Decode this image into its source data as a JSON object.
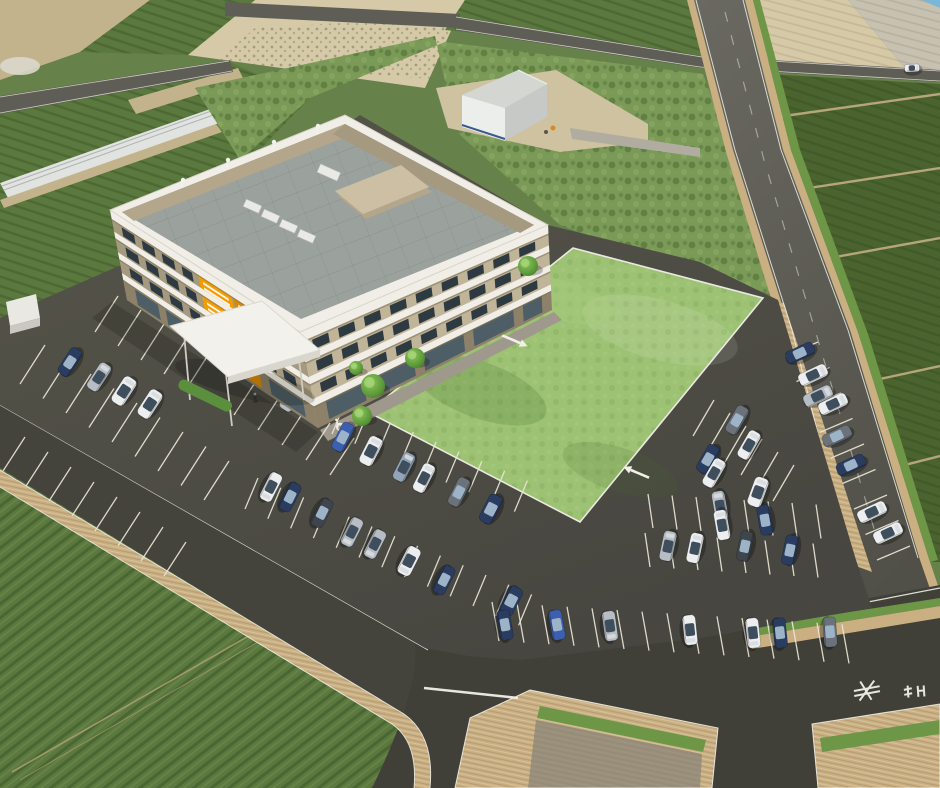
{
  "meta": {
    "title": "aerial-3d-architectural-rendering",
    "width": 940,
    "height": 788,
    "description": "Bird's-eye 3D rendering of a 4-story beige office/hospital building with rooftop equipment, entrance canopy, large lawn, full parking lot with cars, surrounded by farmland and roads"
  },
  "palette": {
    "asphalt": "#4e4d45",
    "asphaltLight": "#5a5950",
    "road": "#5f5e56",
    "roadDark": "#44433c",
    "roadBottom": "#403f38",
    "line": "#f0efe8",
    "stall": "#e9e6d6",
    "lawn": "#9dc273",
    "lawnLight": "#b3d38a",
    "lawnDark": "#83a95a",
    "fieldGreen": "#66824a",
    "fieldGreenRow": "#5b783e",
    "fieldGreenDark": "#4a632f",
    "fieldBush": "#7b9a58",
    "fieldTan": "#d6c9a8",
    "fieldTanDark": "#c3b38c",
    "gravel": "#c6c1b1",
    "dirt": "#cfc2a0",
    "sidewalk": "#c9af81",
    "grassStrip": "#6d9747",
    "curbWall": "#9aa28c",
    "bandWhite": "#f0eee6",
    "trim": "#7d7258",
    "wallSW": "#a59a7f",
    "wallSE": "#c0b499",
    "wallGround": "#8d8269",
    "win": "#2e3a42",
    "glass": "#4e5e66",
    "orange": "#f39c00",
    "orangeDark": "#d98a00",
    "roofGray": "#9ba19c",
    "roofTan": "#b4a68b",
    "roofTanTop": "#cdbfa3",
    "canopy": "#f2f1ec",
    "canopyEdge": "#d9d6cd",
    "pave": "#9e998c",
    "tree1": "#7fbb52",
    "tree2": "#4e8a30",
    "shed": "#e9e8e3",
    "whWall": "#eceeeb",
    "whSide": "#c6c9c5",
    "whRoof": "#d4d6d2",
    "whBase": "#3a5a8c",
    "carNavy": "#2a3c60",
    "carBlue": "#3c5fae",
    "carWhite": "#eceef0",
    "carSilver": "#b7bdc5",
    "carGray": "#6b727a",
    "carDark": "#3f454d",
    "carBlueGray": "#93a5b8",
    "waterCorner": "#7ab6d6"
  },
  "scene": {
    "building": {
      "label": "main-building",
      "floors": 4,
      "sw": {
        "tl": [
          110,
          210
        ],
        "tr": [
          300,
          332
        ],
        "bl": [
          127,
          300
        ],
        "br": [
          318,
          428
        ],
        "wall": "wallSW",
        "bands": [
          [
            0,
            0.1
          ],
          [
            0.24,
            0.075
          ],
          [
            0.47,
            0.075
          ],
          [
            0.7,
            0.075
          ]
        ],
        "winrows": [
          [
            0.125,
            0.225
          ],
          [
            0.345,
            0.45
          ],
          [
            0.575,
            0.675
          ]
        ],
        "slots": [
          [
            0.05,
            0.115
          ],
          [
            0.155,
            0.22
          ],
          [
            0.26,
            0.325
          ],
          [
            0.365,
            0.42
          ],
          [
            0.75,
            0.815
          ],
          [
            0.855,
            0.92
          ]
        ],
        "ground": {
          "t0": 0.8,
          "t1": 0.97,
          "slots": [
            [
              0.06,
              0.18
            ],
            [
              0.22,
              0.34
            ],
            [
              0.76,
              0.94
            ]
          ]
        },
        "orange": [
          {
            "s0": 0.455,
            "s1": 0.63,
            "key": "orange"
          },
          {
            "s0": 0.64,
            "s1": 0.71,
            "key": "orangeDark"
          }
        ]
      },
      "se": {
        "tl": [
          300,
          332
        ],
        "tr": [
          548,
          225
        ],
        "bl": [
          318,
          428
        ],
        "br": [
          552,
          310
        ],
        "wall": "wallSE",
        "bands": [
          [
            0,
            0.1
          ],
          [
            0.24,
            0.075
          ],
          [
            0.47,
            0.075
          ],
          [
            0.7,
            0.075
          ]
        ],
        "winrows": [
          [
            0.125,
            0.225
          ],
          [
            0.345,
            0.45
          ],
          [
            0.575,
            0.675
          ]
        ],
        "slots": [
          [
            0.04,
            0.105
          ],
          [
            0.145,
            0.21
          ],
          [
            0.25,
            0.315
          ],
          [
            0.355,
            0.42
          ],
          [
            0.46,
            0.525
          ],
          [
            0.565,
            0.63
          ],
          [
            0.67,
            0.735
          ],
          [
            0.775,
            0.84
          ],
          [
            0.88,
            0.945
          ]
        ],
        "ground": {
          "t0": 0.78,
          "t1": 0.97,
          "slots": [
            [
              0.05,
              0.21
            ],
            [
              0.25,
              0.42
            ],
            [
              0.46,
              0.63
            ],
            [
              0.67,
              0.84
            ],
            [
              0.88,
              0.96
            ]
          ]
        },
        "orange": []
      }
    },
    "cars": [
      [
        70,
        362,
        -57,
        "carNavy",
        "sedan"
      ],
      [
        99,
        377,
        -57,
        "carSilver",
        "sedan"
      ],
      [
        124,
        391,
        -57,
        "carWhite",
        "van"
      ],
      [
        150,
        404,
        -57,
        "carWhite",
        "van"
      ],
      [
        292,
        397,
        -57,
        "carSilver",
        "van"
      ],
      [
        343,
        437,
        -63,
        "carBlue",
        "sedan"
      ],
      [
        371,
        451,
        -63,
        "carWhite",
        "van"
      ],
      [
        404,
        467,
        -63,
        "carBlueGray",
        "sedan"
      ],
      [
        424,
        478,
        -63,
        "carWhite",
        "sedan"
      ],
      [
        459,
        492,
        -63,
        "carGray",
        "sedan"
      ],
      [
        491,
        509,
        -63,
        "carNavy",
        "van"
      ],
      [
        271,
        487,
        117,
        "carWhite",
        "sedan"
      ],
      [
        290,
        497,
        117,
        "carNavy",
        "sedan"
      ],
      [
        322,
        513,
        117,
        "carDark",
        "sedan"
      ],
      [
        352,
        532,
        117,
        "carSilver",
        "sedan"
      ],
      [
        375,
        544,
        117,
        "carSilver",
        "sedan"
      ],
      [
        409,
        561,
        117,
        "carWhite",
        "van"
      ],
      [
        444,
        580,
        117,
        "carNavy",
        "sedan"
      ],
      [
        511,
        601,
        117,
        "carNavy",
        "van"
      ],
      [
        505,
        625,
        80,
        "carNavy",
        "sedan"
      ],
      [
        557,
        625,
        80,
        "carBlue",
        "sedan"
      ],
      [
        610,
        626,
        82,
        "carSilver",
        "sedan"
      ],
      [
        690,
        630,
        84,
        "carWhite",
        "sedan"
      ],
      [
        753,
        633,
        84,
        "carWhite",
        "sedan"
      ],
      [
        780,
        633,
        84,
        "carNavy",
        "sedan"
      ],
      [
        830,
        632,
        86,
        "carGray",
        "sedan"
      ],
      [
        668,
        546,
        -78,
        "carSilver",
        "sedan"
      ],
      [
        695,
        548,
        -78,
        "carWhite",
        "sedan"
      ],
      [
        745,
        546,
        -78,
        "carDark",
        "sedan"
      ],
      [
        790,
        550,
        -78,
        "carNavy",
        "sedan"
      ],
      [
        720,
        506,
        -100,
        "carSilver",
        "sedan"
      ],
      [
        722,
        525,
        -100,
        "carWhite",
        "sedan"
      ],
      [
        765,
        520,
        -100,
        "carNavy",
        "sedan"
      ],
      [
        708,
        459,
        -60,
        "carNavy",
        "sedan"
      ],
      [
        714,
        473,
        -60,
        "carWhite",
        "sedan"
      ],
      [
        737,
        420,
        -60,
        "carGray",
        "sedan"
      ],
      [
        749,
        445,
        -60,
        "carWhite",
        "sedan"
      ],
      [
        758,
        492,
        -70,
        "carWhite",
        "van"
      ],
      [
        800,
        353,
        -25,
        "carNavy",
        "sedan"
      ],
      [
        813,
        375,
        -25,
        "carWhite",
        "sedan"
      ],
      [
        818,
        396,
        -25,
        "carSilver",
        "sedan"
      ],
      [
        833,
        404,
        -25,
        "carWhite",
        "sedan"
      ],
      [
        837,
        436,
        -25,
        "carGray",
        "sedan"
      ],
      [
        851,
        465,
        -25,
        "carNavy",
        "sedan"
      ],
      [
        872,
        512,
        -25,
        "carWhite",
        "sedan"
      ],
      [
        888,
        533,
        -25,
        "carWhite",
        "sedan"
      ],
      [
        540,
        137,
        10,
        "carNavy",
        "tiny"
      ],
      [
        563,
        143,
        8,
        "carWhite",
        "tiny"
      ],
      [
        912,
        68,
        -3,
        "carWhite",
        "tiny"
      ]
    ],
    "trees": [
      [
        528,
        266,
        10
      ],
      [
        415,
        358,
        10
      ],
      [
        373,
        386,
        12
      ],
      [
        356,
        368,
        7
      ],
      [
        362,
        416,
        10
      ]
    ],
    "stall_rows": [
      {
        "sx": 45,
        "sy": 345,
        "dx": 23,
        "dy": 14.5,
        "lx": -25,
        "ly": 39,
        "n": 9
      },
      {
        "sx": 118,
        "sy": 296,
        "dx": 23,
        "dy": 14,
        "lx": -23,
        "ly": 36,
        "n": 5
      },
      {
        "sx": 258,
        "sy": 378,
        "dx": 24,
        "dy": 15,
        "lx": -24,
        "ly": 37,
        "n": 5
      },
      {
        "sx": 332,
        "sy": 434,
        "dx": 22.8,
        "dy": 9.7,
        "lx": 13,
        "ly": -31,
        "n": 9
      },
      {
        "sx": 258,
        "sy": 478,
        "dx": 22.8,
        "dy": 9.7,
        "lx": -13,
        "ly": 31,
        "n": 13
      },
      {
        "sx": 25,
        "sy": 437,
        "dx": 23,
        "dy": 15,
        "lx": -22,
        "ly": 34,
        "n": 8
      },
      {
        "sx": 492,
        "sy": 602,
        "dx": 25,
        "dy": 1.6,
        "lx": 7,
        "ly": 39,
        "n": 15
      },
      {
        "sx": 648,
        "sy": 494,
        "dx": 24,
        "dy": 1.5,
        "lx": 5,
        "ly": 34,
        "n": 8
      },
      {
        "sx": 645,
        "sy": 533,
        "dx": 24,
        "dy": 1.5,
        "lx": 5,
        "ly": 34,
        "n": 8
      },
      {
        "sx": 693,
        "sy": 436,
        "dx": 16,
        "dy": 13,
        "lx": 21,
        "ly": -36,
        "n": 6
      },
      {
        "sx": 818,
        "sy": 342,
        "dx": 11.5,
        "dy": 25.5,
        "lx": -33,
        "ly": 14,
        "n": 9
      }
    ],
    "accessible_icons": [
      [
        272,
        388
      ],
      [
        313,
        411
      ],
      [
        338,
        425
      ]
    ],
    "people": [
      [
        273,
        368
      ],
      [
        303,
        388
      ],
      [
        345,
        400
      ],
      [
        445,
        338
      ],
      [
        255,
        398
      ]
    ],
    "arrows": [
      {
        "x": 638,
        "y": 473,
        "a": 203
      },
      {
        "x": 513,
        "y": 340,
        "a": 23
      }
    ],
    "road_glyphs": [
      {
        "x": 868,
        "y": 692,
        "rot": -4,
        "segs": [
          [
            -14,
            -2,
            12,
            -5
          ],
          [
            -14,
            3,
            12,
            0
          ],
          [
            -9,
            8,
            7,
            -11
          ],
          [
            3,
            8,
            -7,
            -11
          ]
        ]
      },
      {
        "x": 916,
        "y": 691,
        "rot": -4,
        "segs": [
          [
            -12,
            -2,
            -4,
            -3
          ],
          [
            -12,
            3,
            -4,
            2
          ],
          [
            -8,
            -6,
            -8,
            6
          ],
          [
            2,
            -5,
            2,
            6
          ],
          [
            8,
            -5,
            8,
            6
          ],
          [
            2,
            0,
            8,
            0
          ]
        ]
      }
    ]
  }
}
